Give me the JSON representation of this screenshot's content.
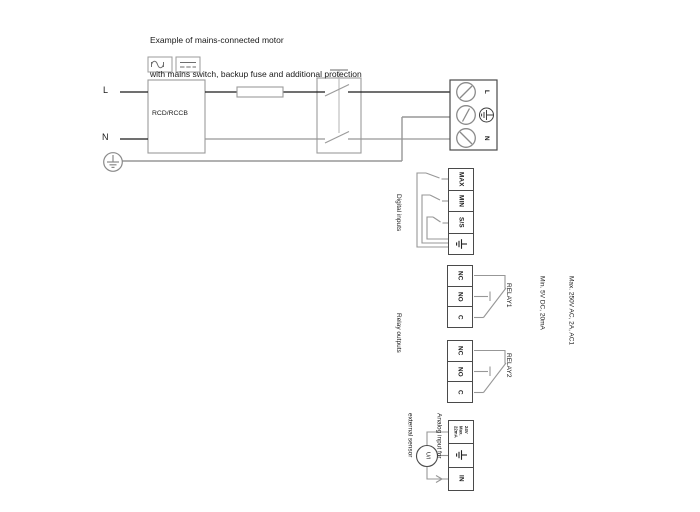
{
  "title": {
    "line1": "Example of mains-connected motor",
    "line2": "with mains switch, backup fuse and additional protection"
  },
  "colors": {
    "wire_gray": "#979797",
    "wire_black": "#1a1a1a",
    "block_border": "#4a4a4a",
    "light_border": "#9b9b9b",
    "text": "#1a1a1a"
  },
  "icons": {
    "protective_earth": "earth-ground-icon",
    "ac_wave": "ac-sine-icon",
    "dc_dashes": "dc-dashes-icon",
    "screw": "screw-terminal-icon",
    "sensor": "sensor-circle-icon",
    "signal_arrow": "signal-arrow-icon",
    "switch_handle": "switch-handle-icon"
  },
  "mains": {
    "l_label": "L",
    "n_label": "N",
    "rcd_label": "RCD/RCCB",
    "terminal_l": "L",
    "terminal_n": "N"
  },
  "digital_inputs": {
    "section_label": "Digital inputs",
    "terminal_max": "MAX",
    "terminal_min": "MIN",
    "terminal_ss": "S/S"
  },
  "relay_outputs": {
    "section_label": "Relay outputs",
    "relay1_label": "RELAY1",
    "relay2_label": "RELAY2",
    "terminal_nc": "NC",
    "terminal_no": "NO",
    "terminal_c": "C",
    "rating_line1": "Max. 250V AC, 2A, AC1",
    "rating_line2": "Min. 5V DC, 20mA"
  },
  "analog_input": {
    "section_line1": "Analog input for",
    "section_line2": "external sensor",
    "supply_line1": "24V",
    "supply_line2": "Max.",
    "supply_line3": "22mA",
    "terminal_in": "IN",
    "sensor_label": "U/I"
  }
}
